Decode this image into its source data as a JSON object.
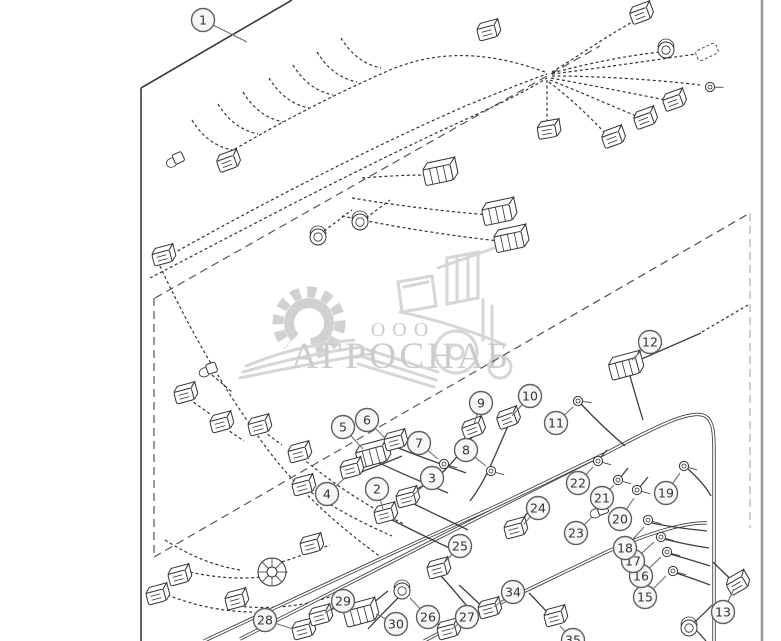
{
  "diagram": {
    "watermark": {
      "company_prefix": "ООО",
      "company_name": "АГРОСНАБ",
      "color": "#c7c7c7"
    },
    "line_color": "#333333",
    "border_color": "#3c3c3c",
    "callouts": [
      {
        "label": "1",
        "cx": 203,
        "cy": 20,
        "lx": 247,
        "ly": 42
      },
      {
        "label": "2",
        "cx": 377,
        "cy": 489,
        "lx": 383,
        "ly": 509
      },
      {
        "label": "3",
        "cx": 432,
        "cy": 478,
        "lx": 411,
        "ly": 497
      },
      {
        "label": "4",
        "cx": 327,
        "cy": 494,
        "lx": 346,
        "ly": 477
      },
      {
        "label": "5",
        "cx": 343,
        "cy": 427,
        "lx": 363,
        "ly": 449
      },
      {
        "label": "6",
        "cx": 367,
        "cy": 420,
        "lx": 385,
        "ly": 438
      },
      {
        "label": "7",
        "cx": 419,
        "cy": 443,
        "lx": 438,
        "ly": 459
      },
      {
        "label": "8",
        "cx": 466,
        "cy": 450,
        "lx": 486,
        "ly": 466
      },
      {
        "label": "9",
        "cx": 481,
        "cy": 403,
        "lx": 474,
        "ly": 424
      },
      {
        "label": "10",
        "cx": 530,
        "cy": 396,
        "lx": 512,
        "ly": 416
      },
      {
        "label": "11",
        "cx": 556,
        "cy": 423,
        "lx": 573,
        "ly": 407
      },
      {
        "label": "12",
        "cx": 650,
        "cy": 342,
        "lx": 632,
        "ly": 360
      },
      {
        "label": "13",
        "cx": 723,
        "cy": 612,
        "lx": 734,
        "ly": 589
      },
      {
        "label": "15",
        "cx": 645,
        "cy": 597,
        "lx": 666,
        "ly": 576
      },
      {
        "label": "16",
        "cx": 641,
        "cy": 576,
        "lx": 661,
        "ly": 557
      },
      {
        "label": "17",
        "cx": 633,
        "cy": 561,
        "lx": 654,
        "ly": 542
      },
      {
        "label": "18",
        "cx": 625,
        "cy": 548,
        "lx": 644,
        "ly": 527
      },
      {
        "label": "19",
        "cx": 666,
        "cy": 493,
        "lx": 680,
        "ly": 473
      },
      {
        "label": "20",
        "cx": 620,
        "cy": 519,
        "lx": 634,
        "ly": 498
      },
      {
        "label": "21",
        "cx": 602,
        "cy": 498,
        "lx": 614,
        "ly": 485
      },
      {
        "label": "22",
        "cx": 578,
        "cy": 483,
        "lx": 593,
        "ly": 467
      },
      {
        "label": "23",
        "cx": 576,
        "cy": 533,
        "lx": 592,
        "ly": 517
      },
      {
        "label": "24",
        "cx": 538,
        "cy": 508,
        "lx": 524,
        "ly": 524
      },
      {
        "label": "25",
        "cx": 460,
        "cy": 546,
        "lx": 443,
        "ly": 564
      },
      {
        "label": "26",
        "cx": 428,
        "cy": 617,
        "lx": 410,
        "ly": 598
      },
      {
        "label": "27",
        "cx": 467,
        "cy": 617,
        "lx": 452,
        "ly": 629
      },
      {
        "label": "28",
        "cx": 265,
        "cy": 620,
        "lx": 293,
        "ly": 629
      },
      {
        "label": "29",
        "cx": 343,
        "cy": 601,
        "lx": 325,
        "ly": 613
      },
      {
        "label": "30",
        "cx": 396,
        "cy": 624,
        "lx": 376,
        "ly": 614
      },
      {
        "label": "34",
        "cx": 513,
        "cy": 592,
        "lx": 494,
        "ly": 607
      },
      {
        "label": "35",
        "cx": 573,
        "cy": 640,
        "lx": 560,
        "ly": 626
      }
    ]
  }
}
